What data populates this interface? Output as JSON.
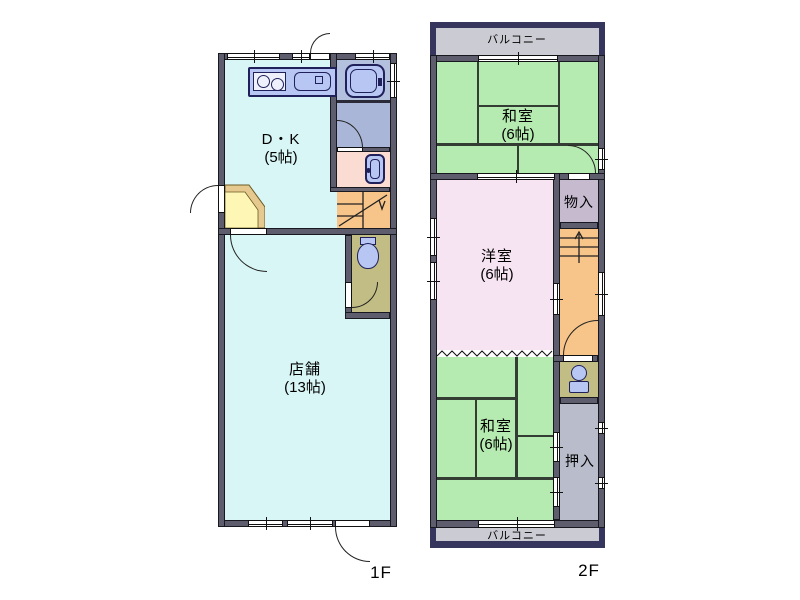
{
  "title": "間取り図",
  "floors": [
    {
      "label": "1F",
      "rooms": {
        "dk": {
          "name": "D・K",
          "size": "(5帖)"
        },
        "shop": {
          "name": "店舗",
          "size": "(13帖)"
        }
      }
    },
    {
      "label": "2F",
      "balcony_top": "バルコニー",
      "balcony_bottom": "バルコニー",
      "rooms": {
        "washitsu_upper": {
          "name": "和室",
          "size": "(6帖)"
        },
        "yoshitsu": {
          "name": "洋室",
          "size": "(6帖)"
        },
        "washitsu_lower": {
          "name": "和室",
          "size": "(6帖)"
        },
        "monoire": {
          "name": "物入"
        },
        "oshiire": {
          "name": "押入"
        }
      }
    }
  ],
  "icons": {
    "kitchen_stove": "two-burner cooktop (css circles)",
    "kitchen_sink": "rounded rect sink (css)",
    "bathtub": "rounded rect tub (css)",
    "washbasin": "rounded rect basin (css)",
    "toilet": "bowl + tank (css)",
    "stairs_up_arrow": "svg arrow",
    "stairs_down_arrow": "svg arrow",
    "accordion_partition": "svg zigzag"
  },
  "palette": {
    "wall": "#5d5d6e",
    "room_cyan": "#d8f6f6",
    "tatami_green": "#b5eab0",
    "western_pink": "#f6e4f2",
    "stairs_orange": "#f7c489",
    "toilet_khaki": "#c2bd84",
    "genkan_yellow": "#fdf6b4",
    "genkan_trim": "#e6c98e",
    "bath_blue": "#b3c0de",
    "changing_blue": "#a9b6d8",
    "washstand_pink": "#fbdcd2",
    "fixture_blue": "#b7c6f2",
    "closet_gray": "#b9bdcb",
    "storage_purple": "#c6bacf",
    "balcony_frame": "#35355e",
    "balcony_fill": "#cbcbd3"
  }
}
